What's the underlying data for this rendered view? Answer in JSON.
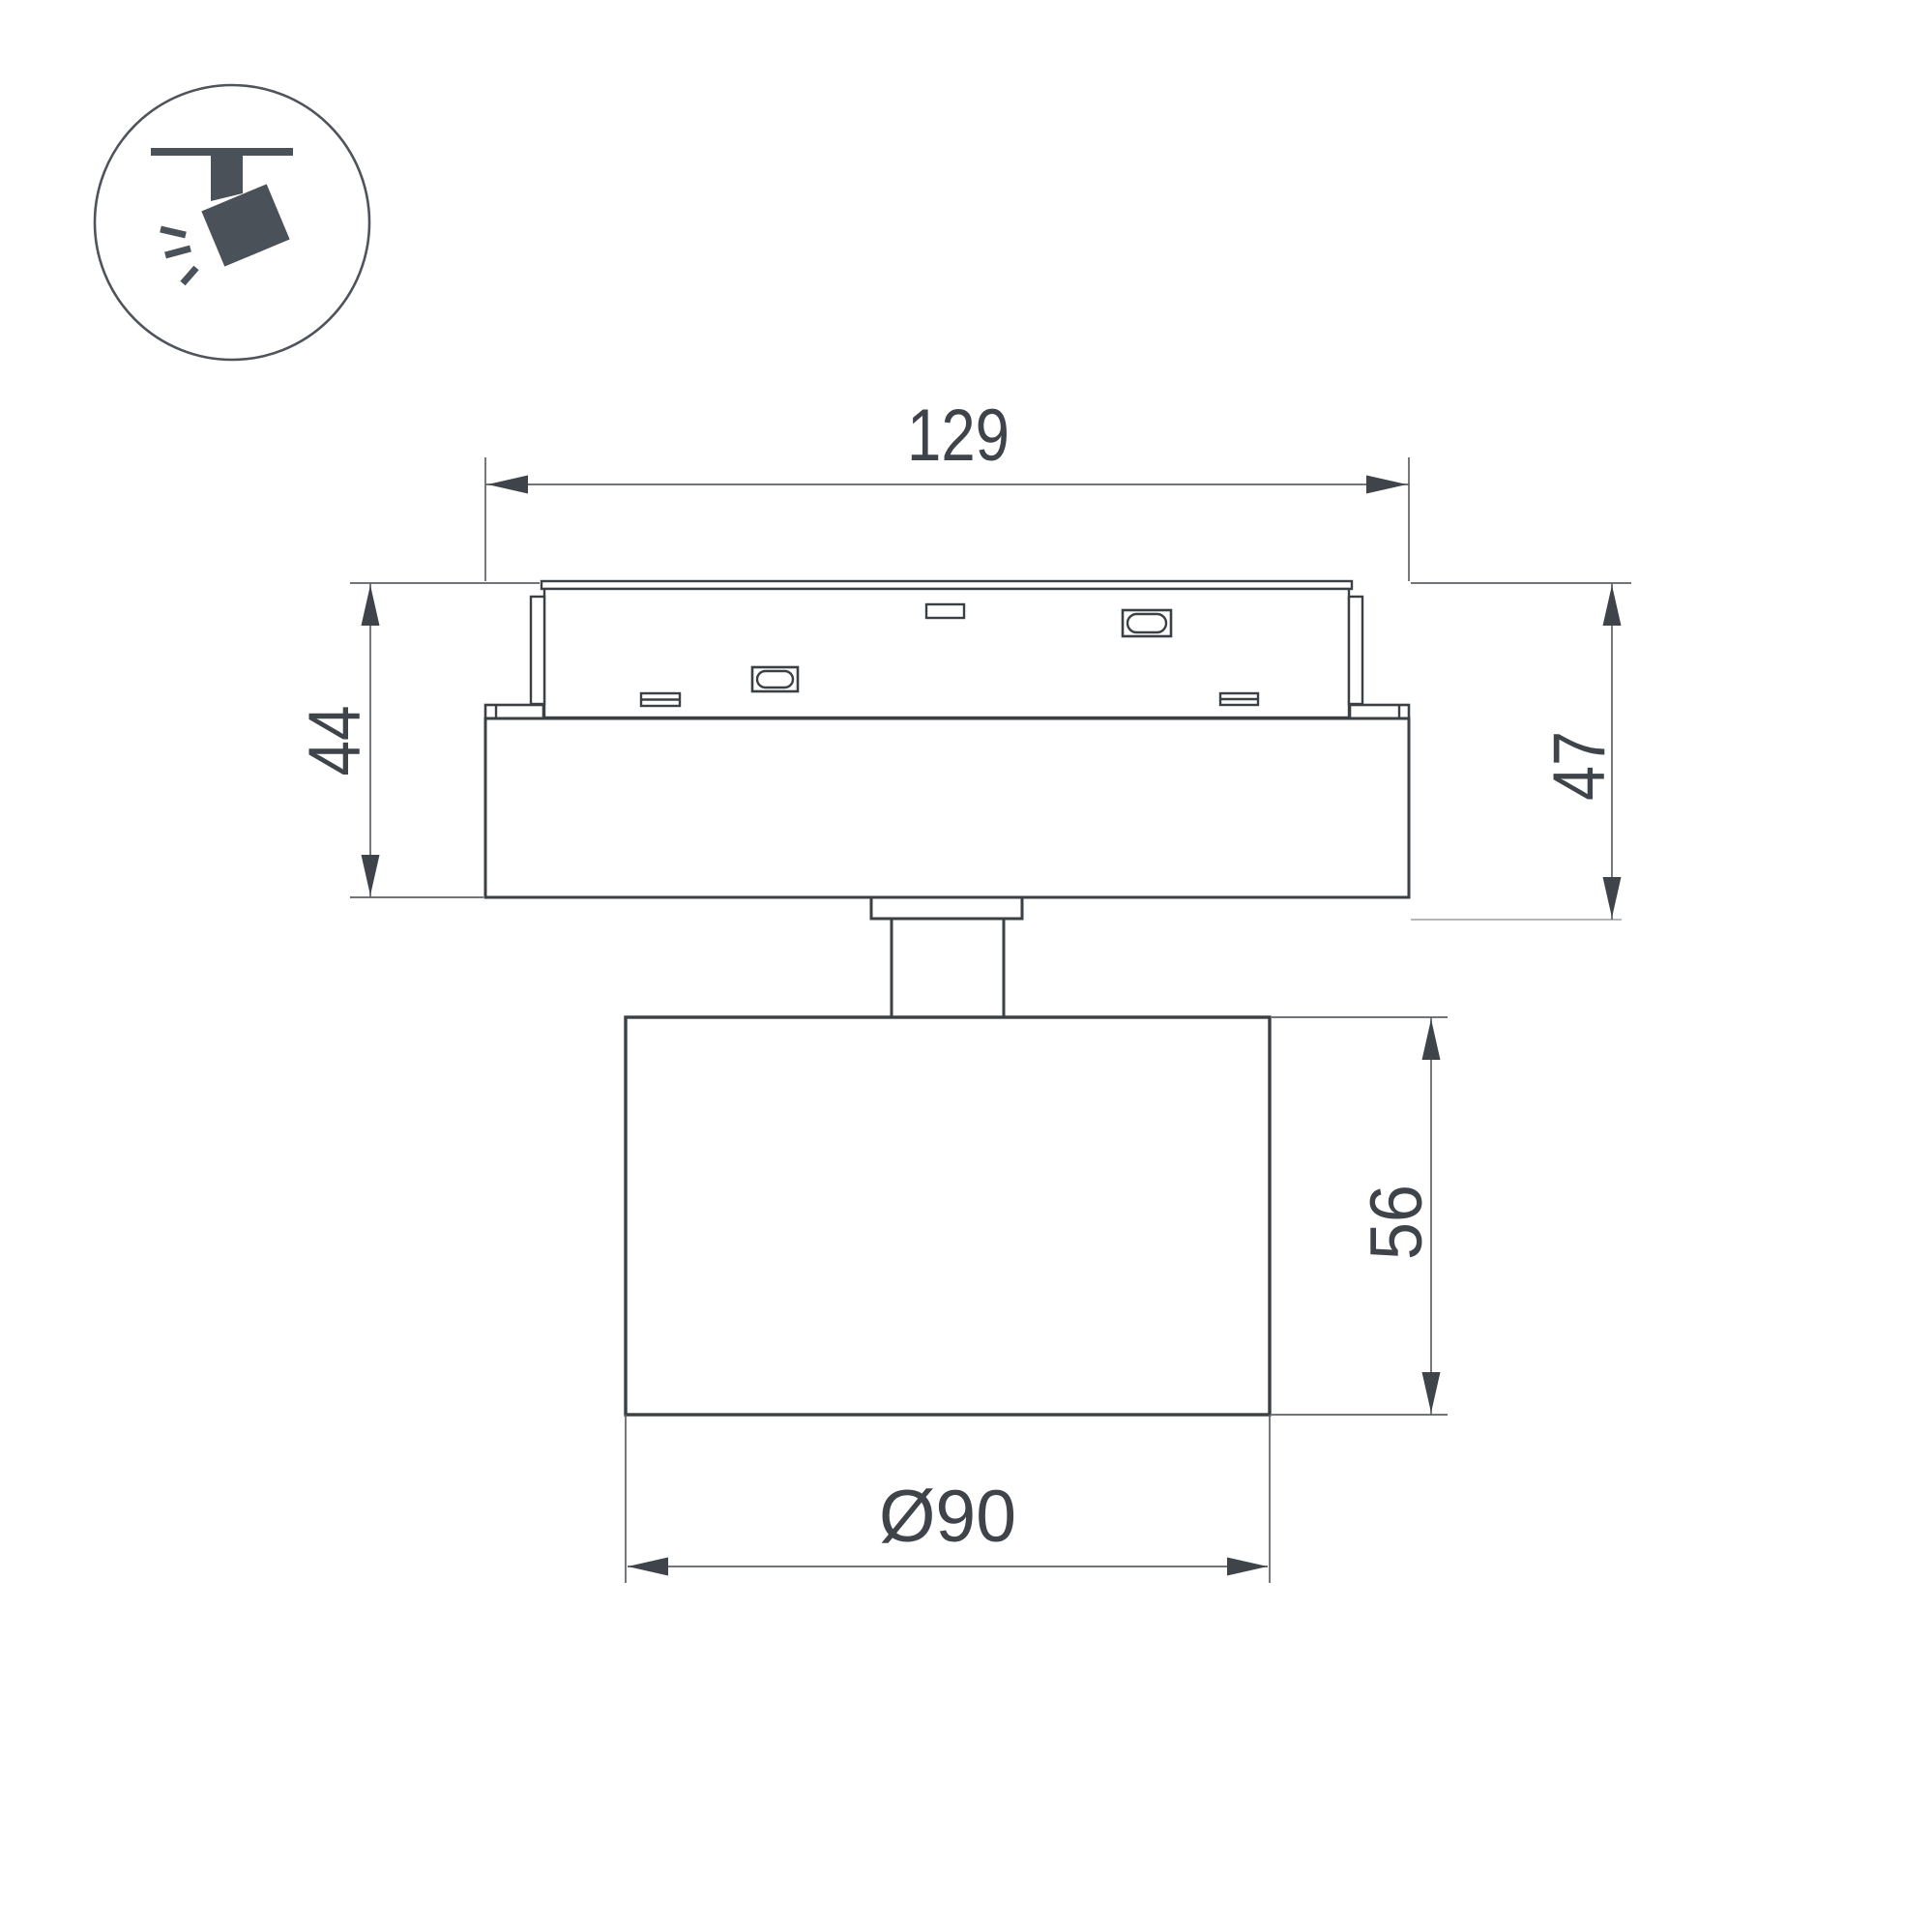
{
  "drawing": {
    "type": "technical-dimension-drawing",
    "subject": "magnetic-track-spot-light-side-view",
    "background": "#ffffff",
    "colors": {
      "outline": "#3b4045",
      "dimension_line": "#5d6165",
      "light_extension_line": "#a9acae",
      "text": "#3f444a",
      "icon": "#4a5158"
    },
    "icon": {
      "name": "ceiling-track-spotlight-icon",
      "shape": "circle-badge-with-track-light-glyph"
    },
    "dimensions": {
      "track_width": "129",
      "left_height": "44",
      "right_height": "47",
      "head_height": "56",
      "head_diameter": "Ø90"
    }
  }
}
